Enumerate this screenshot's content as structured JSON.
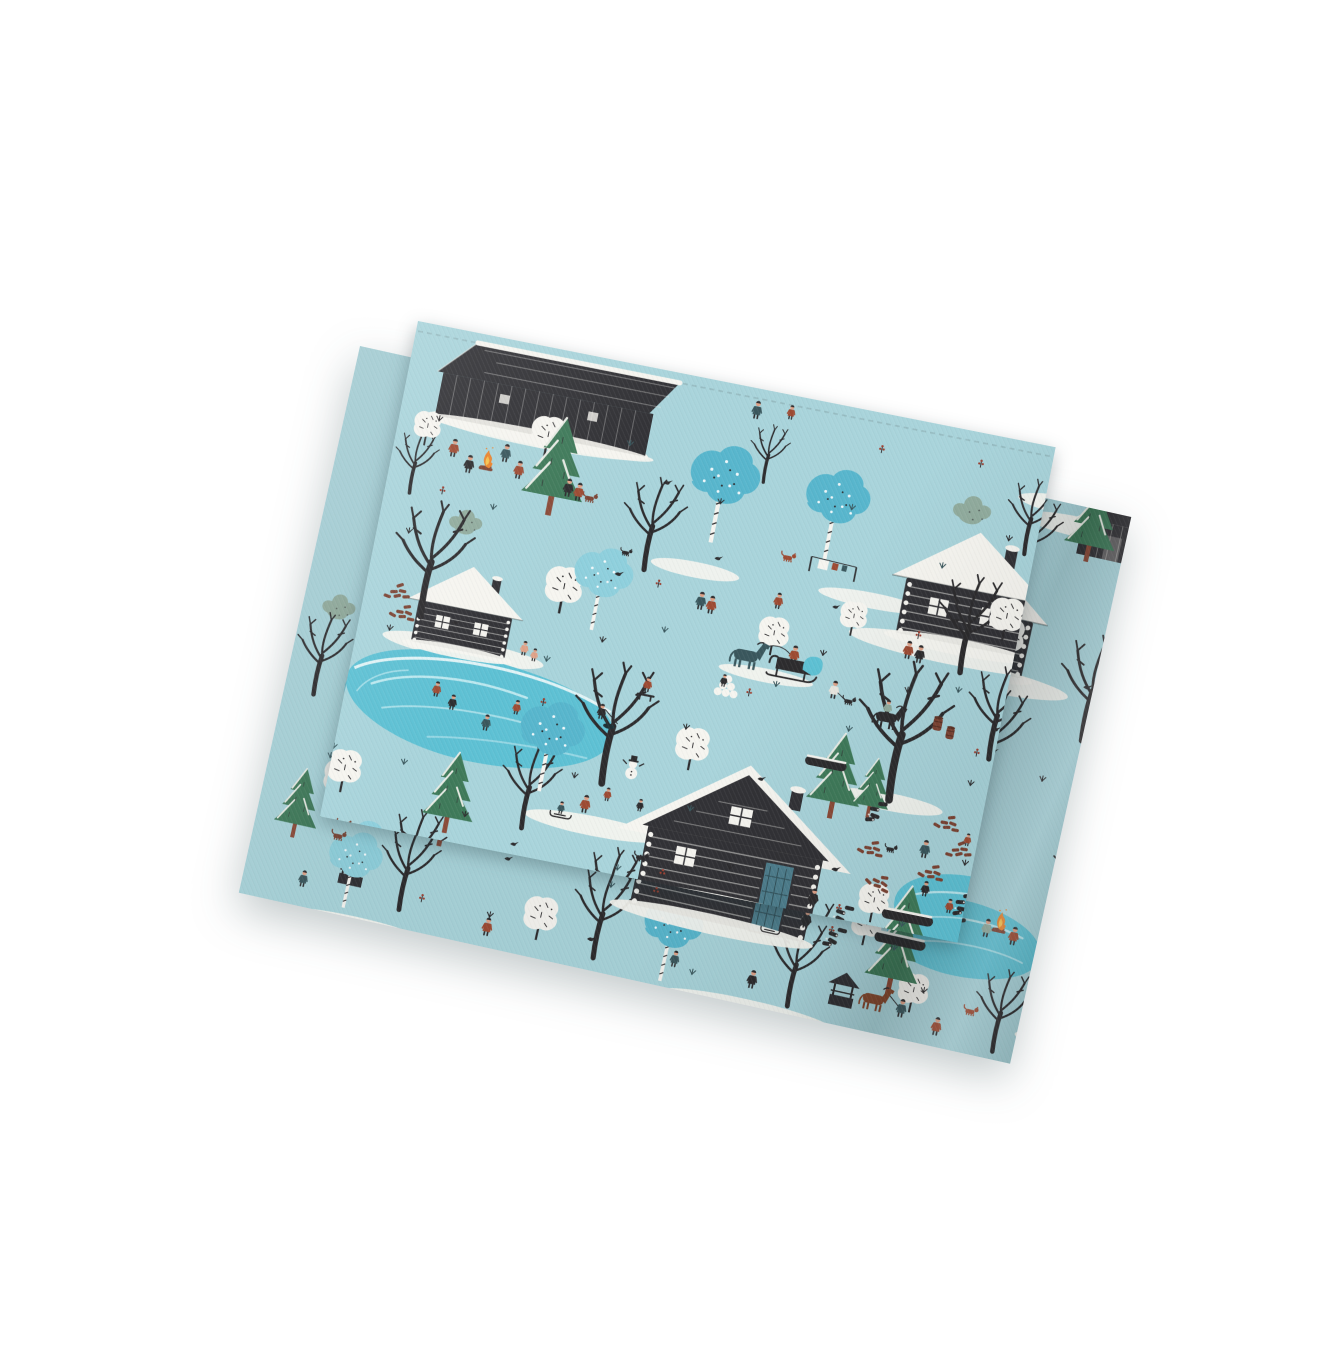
{
  "image": {
    "type": "product-photo",
    "subject": "Folded light-blue tea towel printed with a winter village folk-art pattern",
    "aria_label": "Folded tea towel with winter village print on a white background",
    "background": "plain white studio background"
  },
  "palette": {
    "bg": "#ffffff",
    "base": "#a9d4db",
    "ink": "#2d2c2e",
    "cabin": "#323236",
    "snow": "#f6f5f0",
    "pond": "#5ec1d4",
    "pond_swirl": "#cdeef3",
    "birch": "#58b6cd",
    "birch_light": "#8fd0dd",
    "spruce": "#3f7a5a",
    "trunk": "#8a4a38",
    "wood": "#7c4434",
    "sage": "#91ac9e",
    "fire": "#e9832d",
    "fire_inner": "#f6c14d",
    "skin": "#dfa288",
    "rust": "#9d4b33",
    "teal": "#3a575d",
    "door": "#4e7e8d",
    "horse_brown": "#84492f"
  },
  "pattern_motifs": [
    "log cabin with snow-covered roof",
    "long dark log barn",
    "small sauna cabin with bathers",
    "front-gable cabin with blue door",
    "bare black winter trees",
    "blue birch trees with dotted trunks",
    "snow-laden green spruce trees",
    "white snowy bushes",
    "sage-green star clouds",
    "frozen turquoise pond with ice skaters",
    "fisherman at an ice hole",
    "snowman with black top hat",
    "horse-drawn sleigh with driver",
    "child riding a black horse",
    "brown horse led by a villager",
    "villagers dancing around a bonfire",
    "children sledding",
    "clothesline with laundry",
    "stacks of firewood and brown bricks",
    "wooden barrels and log piles",
    "well with little roof",
    "dogs, cats and crows",
    "grass tufts, twigs and berry sprigs"
  ],
  "fold": {
    "description": "towel folded in half; top panel rotated about 11 degrees, under fold peeking out at the left, right and bottom edges"
  }
}
